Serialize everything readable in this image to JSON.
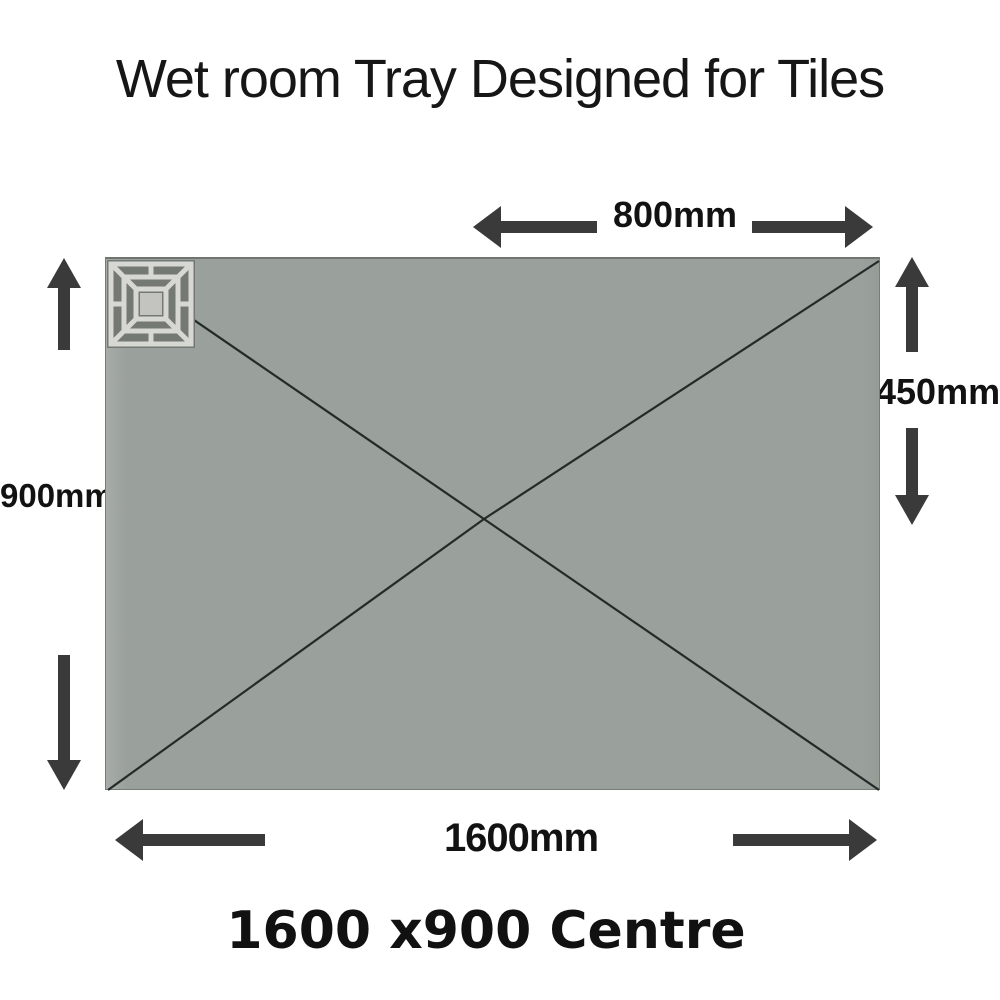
{
  "title": "Wet room Tray Designed for Tiles",
  "caption": "1600 x900 Centre",
  "dimensions": {
    "top_half_width": "800mm",
    "right_half_height": "450mm",
    "left_height": "900mm",
    "bottom_width": "1600mm"
  },
  "tray": {
    "shape": "rectangle",
    "drain_position": "centre",
    "fill_color": "#9aa09c"
  },
  "colors": {
    "background": "#ffffff",
    "arrow": "#3a3a3a",
    "diagonal_line": "#232b29",
    "text": "#141414",
    "drain_light": "#d7d7d3",
    "drain_dark": "#747974"
  },
  "icons": {
    "drain": "drain-grate-icon",
    "arrows": "dimension-arrow-icon"
  }
}
